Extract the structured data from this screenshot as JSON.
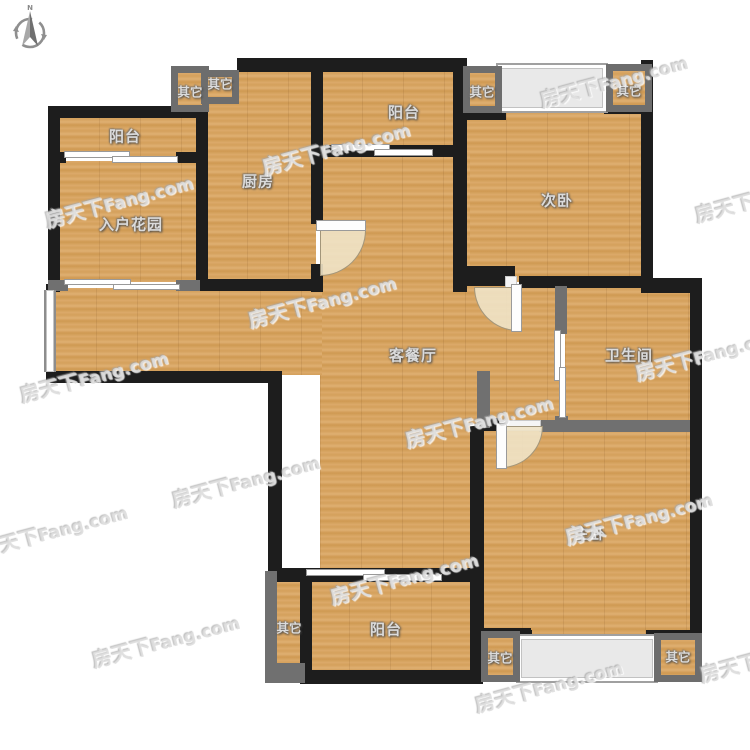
{
  "compass": {
    "north_label": "N"
  },
  "watermark": {
    "brand": "房天下",
    "suffix": "Fang.com",
    "full": "房天下Fang.com"
  },
  "rooms": {
    "balcony_top_left": "阳台",
    "entry_garden": "入户花园",
    "kitchen": "厨房",
    "balcony_top": "阳台",
    "bedroom_second": "次卧",
    "living_dining": "客餐厅",
    "bathroom": "卫生间",
    "bedroom_master": "主卧",
    "balcony_bottom": "阳台",
    "other": "其它"
  },
  "colors": {
    "wall": "#1d1d1d",
    "wall_light": "#707070",
    "floor_wood": "#d5a161",
    "bay_fill": "#e9e9e9",
    "door_swing": "#efe3c7",
    "label_text": "#dbdbdb",
    "watermark": "#dbdbdb",
    "background": "#ffffff"
  }
}
